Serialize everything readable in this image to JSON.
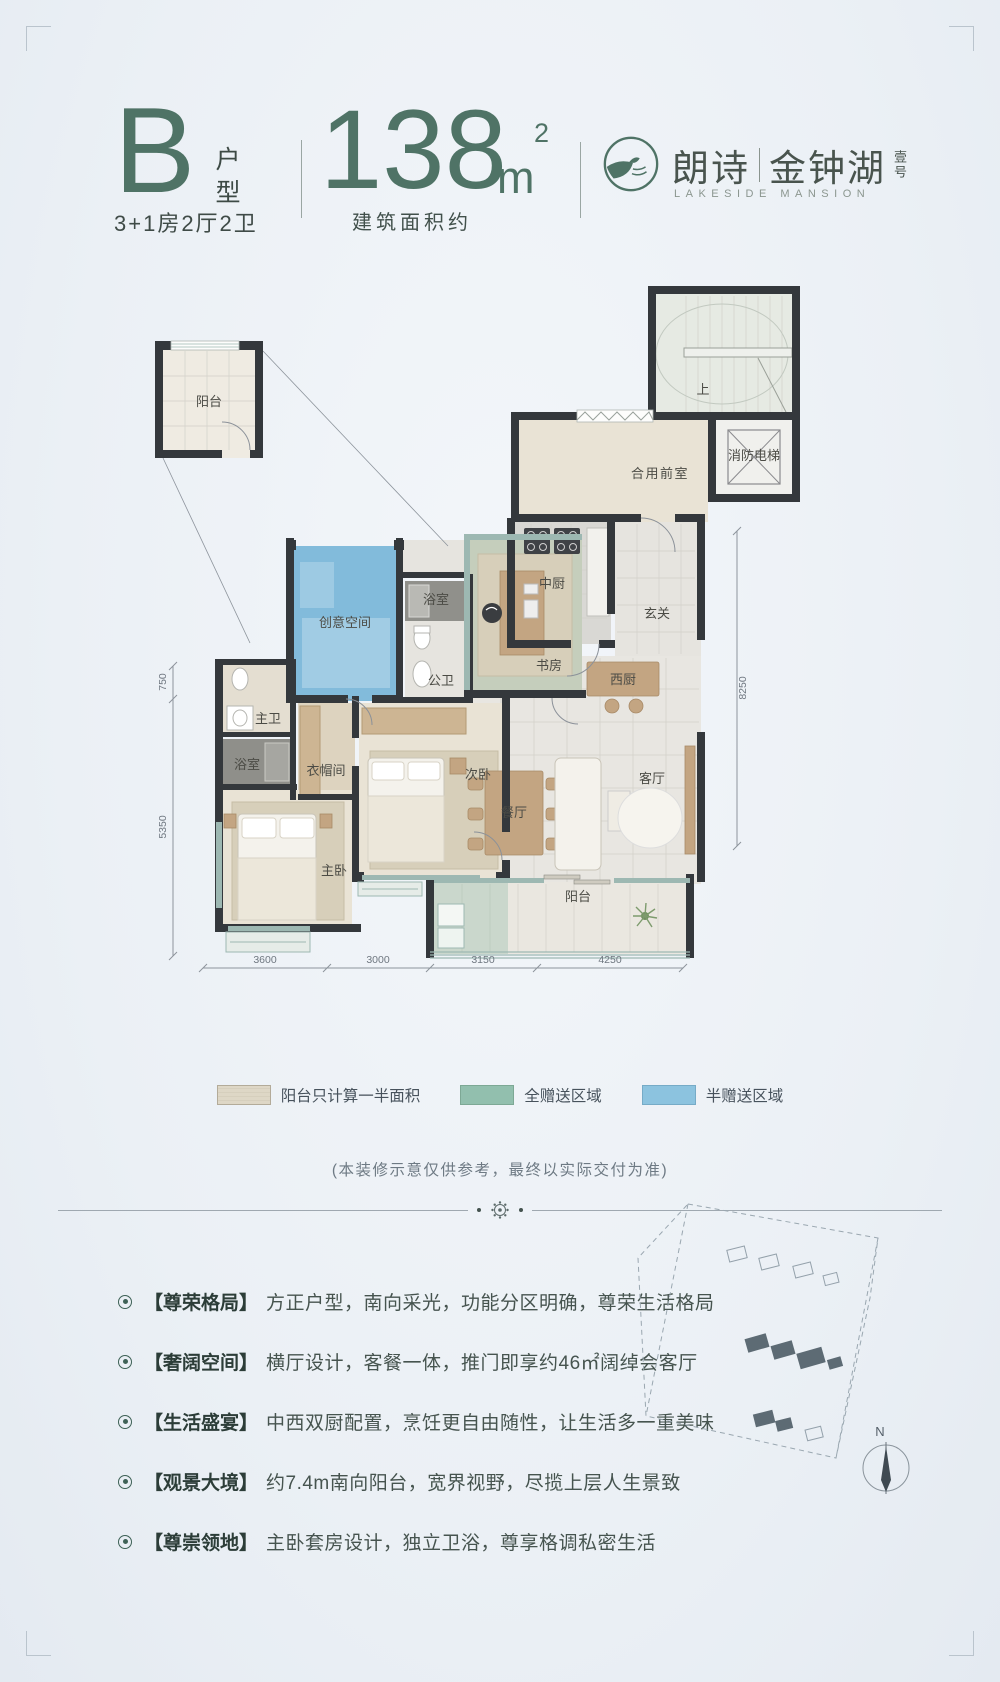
{
  "header": {
    "type_letter": "B",
    "type_label": "户型",
    "type_sub": "3+1房2厅2卫",
    "area_number": "138",
    "area_unit": "m",
    "area_sup": "2",
    "area_caption": "建筑面积约",
    "brand_cn_1": "朗诗",
    "brand_cn_2": "金钟湖",
    "brand_suffix": "壹号",
    "brand_en": "LAKESIDE MANSION",
    "accent_color": "#4f7366"
  },
  "floor_plan": {
    "inset_label": "阳台",
    "rooms": [
      {
        "label": "合用前室"
      },
      {
        "label": "消防电梯"
      },
      {
        "label": "上"
      },
      {
        "label": "中厨"
      },
      {
        "label": "玄关"
      },
      {
        "label": "书房"
      },
      {
        "label": "浴室"
      },
      {
        "label": "公卫"
      },
      {
        "label": "创意空间"
      },
      {
        "label": "主卫"
      },
      {
        "label": "浴室"
      },
      {
        "label": "衣帽间"
      },
      {
        "label": "次卧"
      },
      {
        "label": "主卧"
      },
      {
        "label": "餐厅"
      },
      {
        "label": "客厅"
      },
      {
        "label": "西厨"
      },
      {
        "label": "阳台"
      }
    ],
    "dims_bottom": [
      "3600",
      "3000",
      "3150",
      "4250"
    ],
    "dims_left": [
      "750",
      "5350"
    ],
    "dims_right": [
      "8250"
    ],
    "colors": {
      "wall": "#34383c",
      "half_gift_blue": "#74b3d8",
      "full_gift_green": "#8fb9a6",
      "balcony_beige": "#e9e3d5"
    }
  },
  "legend": {
    "items": [
      {
        "label": "阳台只计算一半面积",
        "color": "#ded7c6"
      },
      {
        "label": "全赠送区域",
        "color": "#92bfae"
      },
      {
        "label": "半赠送区域",
        "color": "#8cc3df"
      }
    ]
  },
  "disclaimer": "(本装修示意仅供参考，最终以实际交付为准)",
  "features": [
    {
      "tag": "【尊荣格局】",
      "text": "方正户型，南向采光，功能分区明确，尊荣生活格局"
    },
    {
      "tag": "【奢阔空间】",
      "text": "横厅设计，客餐一体，推门即享约46㎡阔绰会客厅"
    },
    {
      "tag": "【生活盛宴】",
      "text": "中西双厨配置，烹饪更自由随性，让生活多一重美味"
    },
    {
      "tag": "【观景大境】",
      "text": "约7.4m南向阳台，宽界视野，尽揽上层人生景致"
    },
    {
      "tag": "【尊崇领地】",
      "text": "主卧套房设计，独立卫浴，尊享格调私密生活"
    }
  ],
  "compass": {
    "label": "N"
  }
}
